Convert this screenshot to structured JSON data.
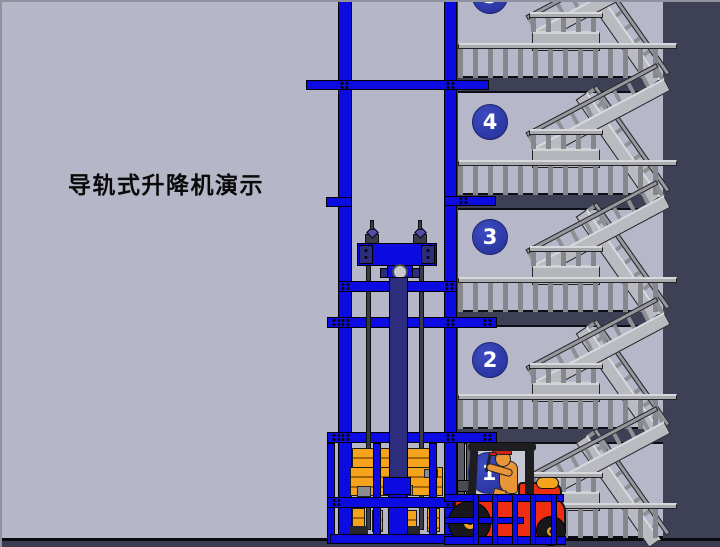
{
  "window": {
    "width": 720,
    "height": 547
  },
  "title": {
    "text": "导轨式升降机演示"
  },
  "building": {
    "floors": [
      {
        "id": "floor-5",
        "label": "5"
      },
      {
        "id": "floor-4",
        "label": "4"
      },
      {
        "id": "floor-3",
        "label": "3"
      },
      {
        "id": "floor-2",
        "label": "2"
      },
      {
        "id": "floor-1",
        "label": "1"
      }
    ]
  },
  "scene": {
    "objects": [
      {
        "name": "guide-rail-mast"
      },
      {
        "name": "hydraulic-carriage-assembly"
      },
      {
        "name": "lift-platform-cage"
      },
      {
        "name": "cargo-pallets"
      },
      {
        "name": "forklift"
      },
      {
        "name": "forklift-driver"
      },
      {
        "name": "ground-safety-gate"
      },
      {
        "name": "staircase"
      },
      {
        "name": "floor-number-badge"
      }
    ]
  },
  "colors": {
    "background_light": "#b6b8c9",
    "building_core": "#3e4156",
    "mast_blue": "#0b0be2",
    "piston_indigo": "#2d2d7e",
    "badge_blue": "#2e3aa8",
    "cargo_orange": "#f5a31d",
    "forklift_red": "#ee2d12",
    "railing_gray": "#a9abaf"
  }
}
